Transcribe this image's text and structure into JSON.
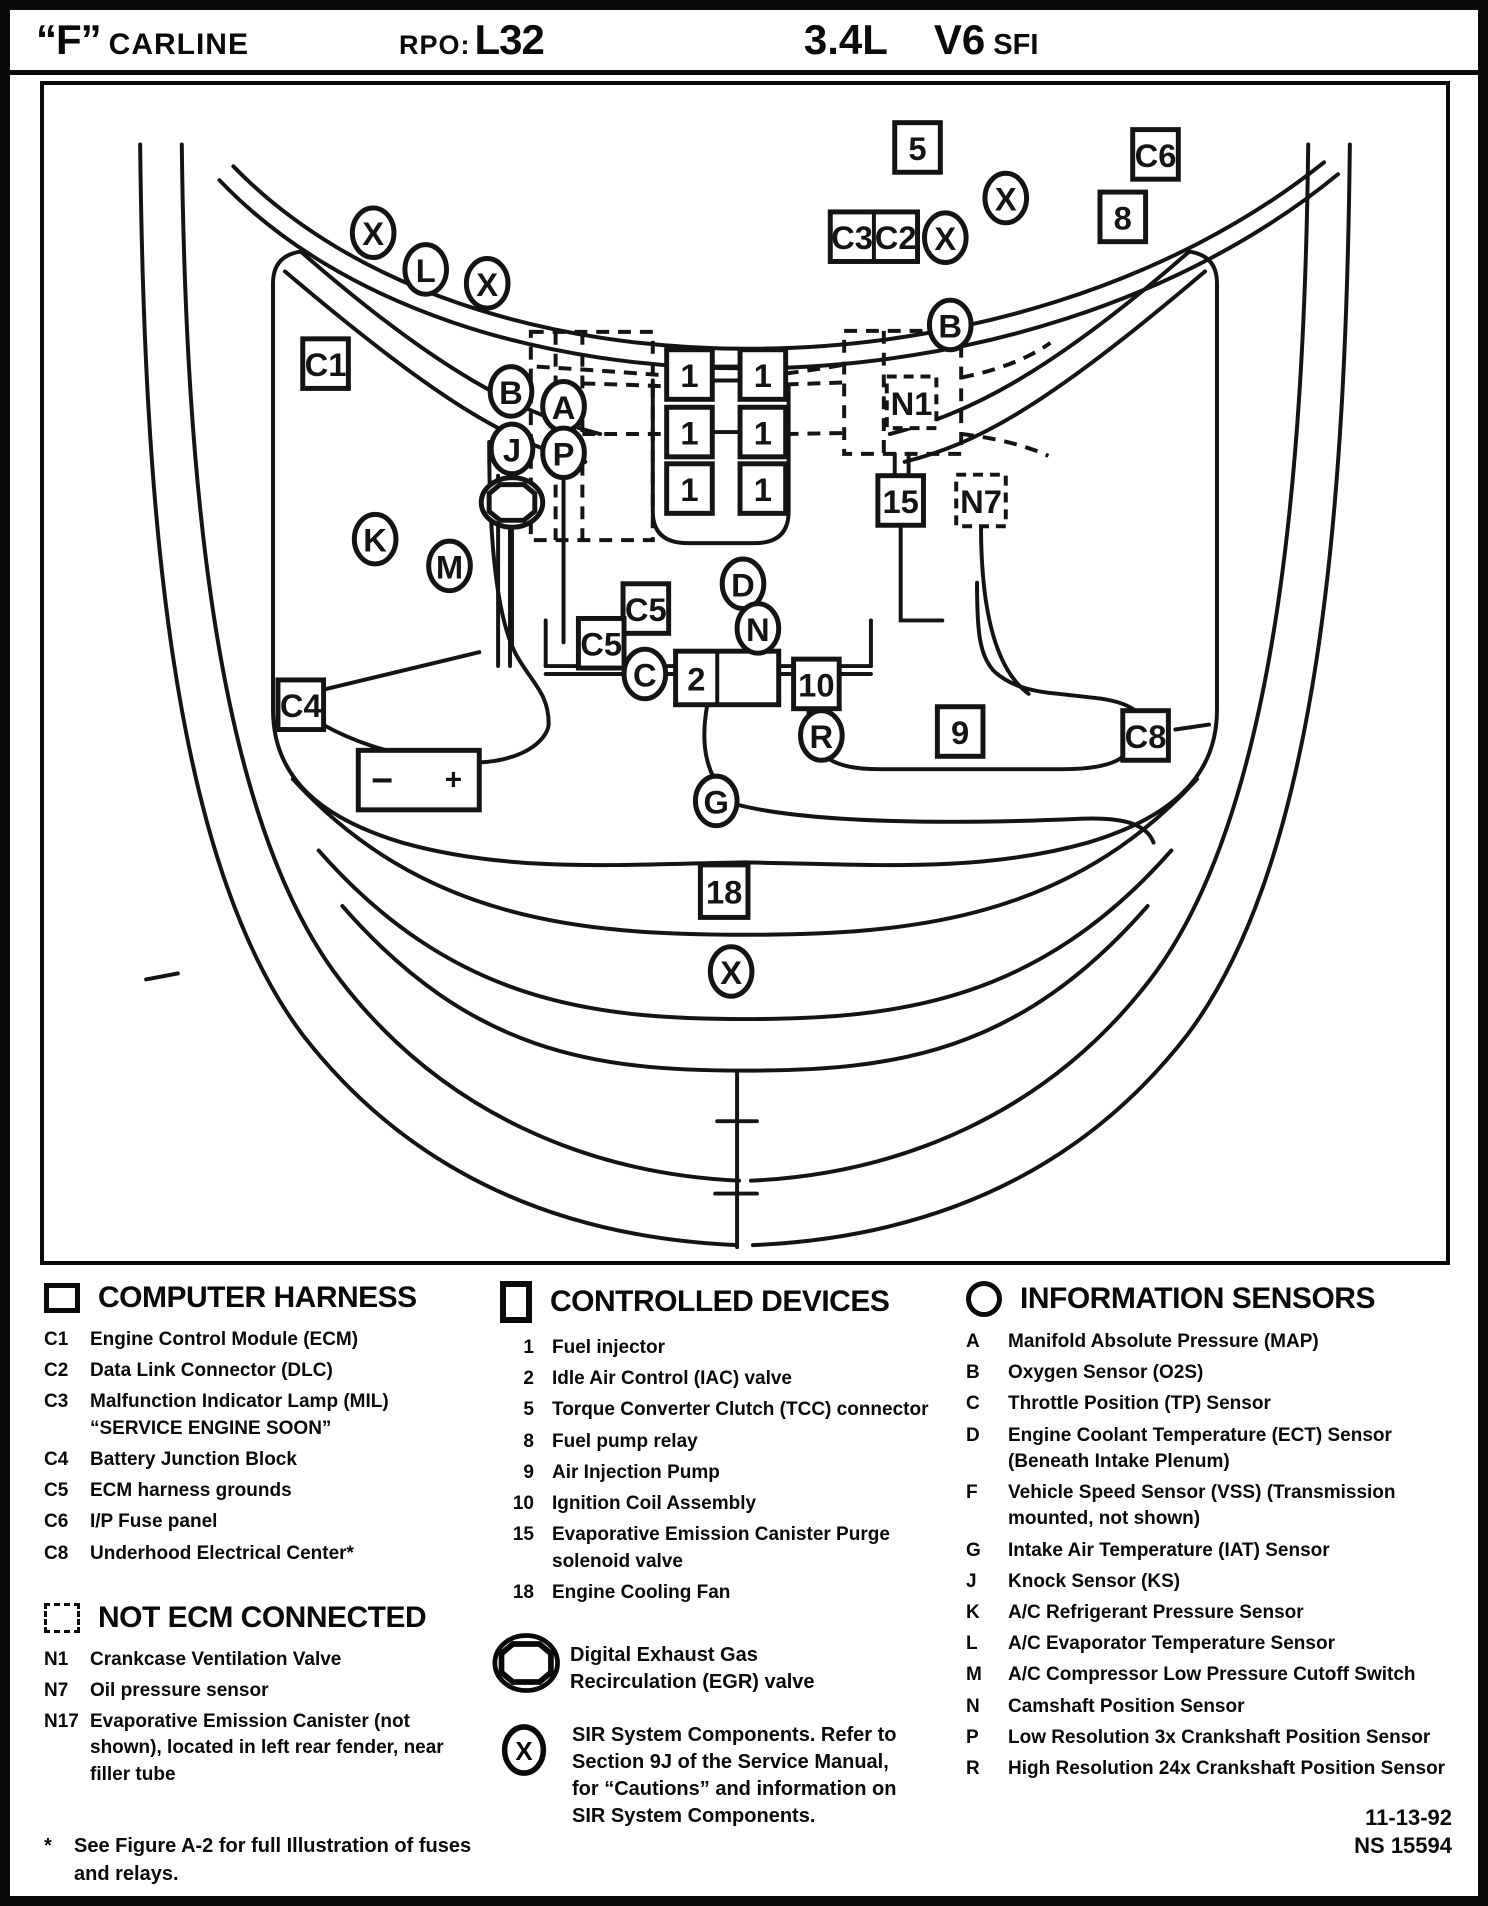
{
  "header": {
    "f_quote": "“F”",
    "carline": "CARLINE",
    "rpo_label": "RPO:",
    "rpo_value": "L32",
    "displacement": "3.4L",
    "cylinders": "V6",
    "fuel": "SFI"
  },
  "diagram": {
    "markers": {
      "boxes": [
        {
          "label": "5",
          "x": 880,
          "y": 63
        },
        {
          "label": "C6",
          "x": 1120,
          "y": 70
        },
        {
          "label": "8",
          "x": 1087,
          "y": 133
        },
        {
          "label": "C1",
          "x": 283,
          "y": 281
        },
        {
          "label": "15",
          "x": 863,
          "y": 419
        },
        {
          "label": "C5",
          "x": 606,
          "y": 528
        },
        {
          "label": "C5",
          "x": 561,
          "y": 563
        },
        {
          "label": "10",
          "x": 778,
          "y": 604
        },
        {
          "label": "9",
          "x": 923,
          "y": 652
        },
        {
          "label": "C8",
          "x": 1110,
          "y": 656
        },
        {
          "label": "C4",
          "x": 258,
          "y": 625
        },
        {
          "label": "18",
          "x": 685,
          "y": 813,
          "w": 48,
          "h": 53
        },
        {
          "label": "1",
          "x": 650,
          "y": 292
        },
        {
          "label": "1",
          "x": 724,
          "y": 292
        },
        {
          "label": "1",
          "x": 650,
          "y": 350
        },
        {
          "label": "1",
          "x": 724,
          "y": 350
        },
        {
          "label": "1",
          "x": 650,
          "y": 407
        },
        {
          "label": "1",
          "x": 724,
          "y": 407
        }
      ],
      "dashed_boxes": [
        {
          "label": "N1",
          "x": 874,
          "y": 320
        },
        {
          "label": "N7",
          "x": 944,
          "y": 419
        }
      ],
      "split_boxes": [
        {
          "labels": [
            "C3",
            "C2"
          ],
          "x": 836,
          "y": 153,
          "w": 88,
          "h": 50,
          "div": 44
        },
        {
          "labels": [
            "2",
            ""
          ],
          "x": 688,
          "y": 598,
          "w": 104,
          "h": 54,
          "div": 42
        }
      ],
      "circles": [
        {
          "label": "X",
          "x": 331,
          "y": 149
        },
        {
          "label": "L",
          "x": 384,
          "y": 186
        },
        {
          "label": "X",
          "x": 446,
          "y": 200
        },
        {
          "label": "X",
          "x": 969,
          "y": 114
        },
        {
          "label": "X",
          "x": 908,
          "y": 154
        },
        {
          "label": "B",
          "x": 913,
          "y": 242
        },
        {
          "label": "B",
          "x": 470,
          "y": 309
        },
        {
          "label": "A",
          "x": 523,
          "y": 324
        },
        {
          "label": "J",
          "x": 471,
          "y": 367
        },
        {
          "label": "P",
          "x": 523,
          "y": 371
        },
        {
          "label": "K",
          "x": 333,
          "y": 458
        },
        {
          "label": "M",
          "x": 408,
          "y": 485
        },
        {
          "label": "D",
          "x": 704,
          "y": 503
        },
        {
          "label": "N",
          "x": 719,
          "y": 548
        },
        {
          "label": "C",
          "x": 605,
          "y": 594
        },
        {
          "label": "R",
          "x": 783,
          "y": 656
        },
        {
          "label": "G",
          "x": 677,
          "y": 722
        },
        {
          "label": "X",
          "x": 692,
          "y": 894
        }
      ],
      "egr_symbol": {
        "x": 471,
        "y": 421
      },
      "battery": {
        "x": 316,
        "y": 671,
        "w": 122,
        "h": 60,
        "minus": "−",
        "plus": "+"
      }
    }
  },
  "legend": {
    "computer_harness": {
      "title": "COMPUTER HARNESS",
      "items": [
        {
          "key": "C1",
          "text": "Engine Control Module (ECM)"
        },
        {
          "key": "C2",
          "text": "Data Link Connector (DLC)"
        },
        {
          "key": "C3",
          "text": "Malfunction Indicator Lamp (MIL) “SERVICE ENGINE SOON”"
        },
        {
          "key": "C4",
          "text": "Battery Junction Block"
        },
        {
          "key": "C5",
          "text": "ECM harness grounds"
        },
        {
          "key": "C6",
          "text": "I/P Fuse panel"
        },
        {
          "key": "C8",
          "text": "Underhood Electrical Center*"
        }
      ]
    },
    "not_ecm": {
      "title": "NOT ECM CONNECTED",
      "items": [
        {
          "key": "N1",
          "text": "Crankcase Ventilation Valve"
        },
        {
          "key": "N7",
          "text": "Oil pressure sensor"
        },
        {
          "key": "N17",
          "text": "Evaporative Emission Canister (not shown), located in left rear fender, near filler tube"
        }
      ]
    },
    "footnote_mark": "*",
    "footnote": "See Figure A-2 for full Illustration of fuses and relays.",
    "controlled_devices": {
      "title": "CONTROLLED DEVICES",
      "items": [
        {
          "key": "1",
          "text": "Fuel injector"
        },
        {
          "key": "2",
          "text": "Idle Air Control (IAC) valve"
        },
        {
          "key": "5",
          "text": "Torque Converter Clutch (TCC) connector"
        },
        {
          "key": "8",
          "text": "Fuel pump relay"
        },
        {
          "key": "9",
          "text": "Air Injection Pump"
        },
        {
          "key": "10",
          "text": "Ignition Coil Assembly"
        },
        {
          "key": "15",
          "text": "Evaporative Emission Canister Purge solenoid valve"
        },
        {
          "key": "18",
          "text": "Engine Cooling Fan"
        }
      ]
    },
    "egr_note": "Digital Exhaust Gas Recirculation (EGR) valve",
    "sir_key": "X",
    "sir_note": "SIR System Components.  Refer to Section 9J of the Service Manual, for “Cautions” and information on SIR System Components.",
    "information_sensors": {
      "title": "INFORMATION SENSORS",
      "items": [
        {
          "key": "A",
          "text": "Manifold Absolute Pressure (MAP)"
        },
        {
          "key": "B",
          "text": "Oxygen Sensor (O2S)"
        },
        {
          "key": "C",
          "text": "Throttle Position (TP) Sensor"
        },
        {
          "key": "D",
          "text": "Engine Coolant Temperature (ECT) Sensor (Beneath Intake Plenum)"
        },
        {
          "key": "F",
          "text": "Vehicle Speed Sensor (VSS) (Transmission mounted, not shown)"
        },
        {
          "key": "G",
          "text": "Intake Air Temperature (IAT) Sensor"
        },
        {
          "key": "J",
          "text": "Knock Sensor (KS)"
        },
        {
          "key": "K",
          "text": "A/C Refrigerant Pressure Sensor"
        },
        {
          "key": "L",
          "text": "A/C Evaporator Temperature Sensor"
        },
        {
          "key": "M",
          "text": "A/C Compressor Low Pressure Cutoff Switch"
        },
        {
          "key": "N",
          "text": "Camshaft Position Sensor"
        },
        {
          "key": "P",
          "text": "Low Resolution 3x Crankshaft Position Sensor"
        },
        {
          "key": "R",
          "text": "High Resolution 24x Crankshaft Position Sensor"
        }
      ]
    },
    "date": "11-13-92",
    "doc_number": "NS 15594"
  }
}
